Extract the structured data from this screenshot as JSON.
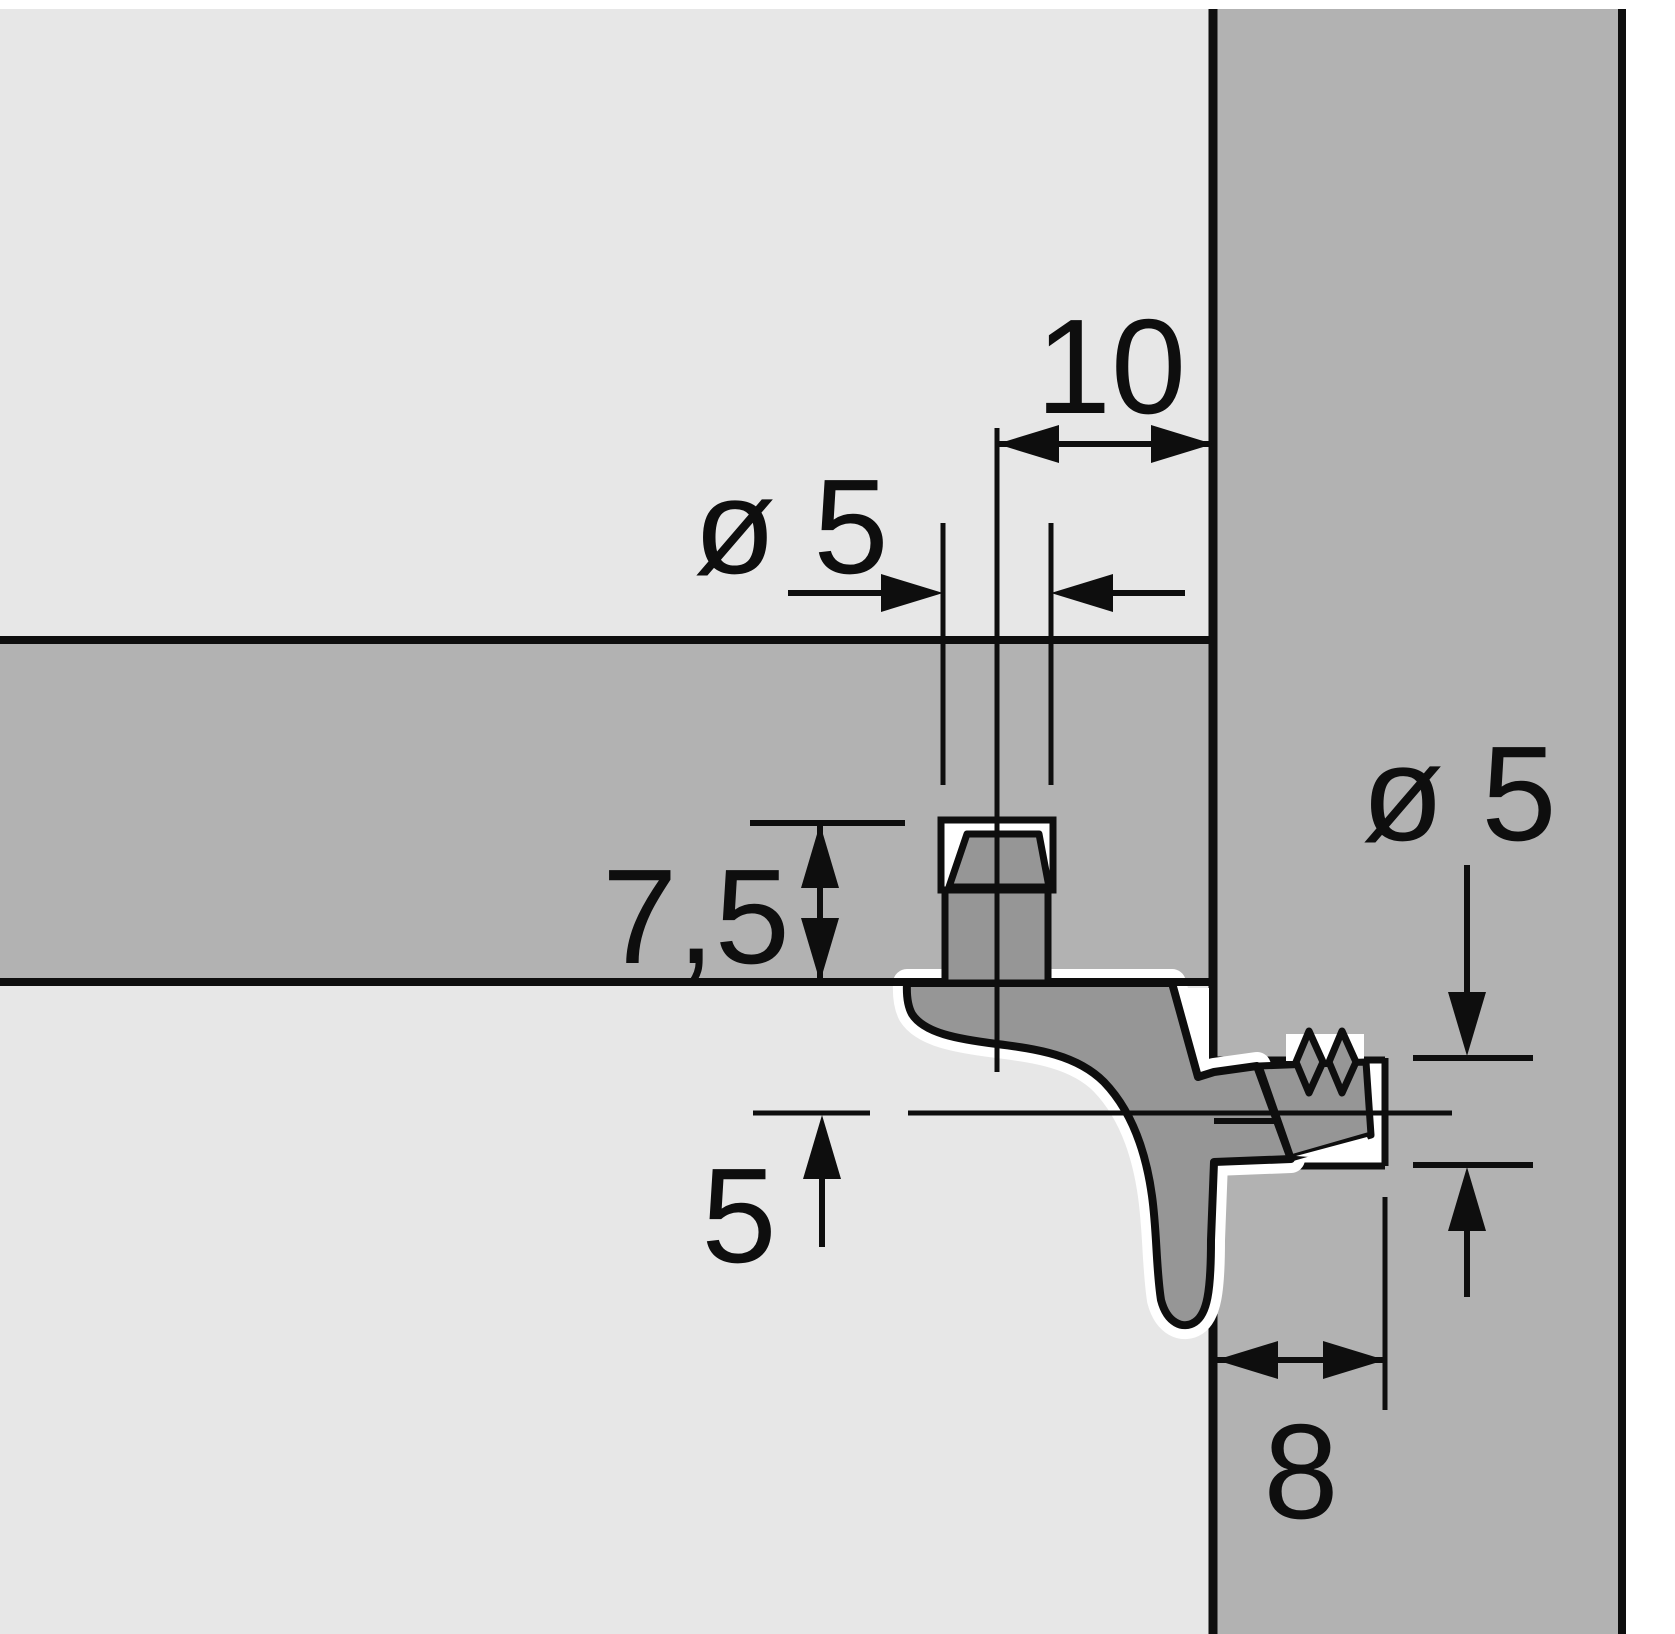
{
  "diagram": {
    "kind": "furniture shelf-support mounting cross-section",
    "labels": {
      "edge_distance": "10",
      "shelf_hole_diameter": "ø 5",
      "shelf_hole_depth": "7,5",
      "panel_hole_diameter": "ø 5",
      "support_offset": "5",
      "panel_hole_depth": "8"
    },
    "colors": {
      "bg": "#e7e7e7",
      "wood": "#b2b2b2",
      "fitting": "#969696",
      "ink": "#0e0e0e",
      "paper": "#ffffff"
    }
  }
}
